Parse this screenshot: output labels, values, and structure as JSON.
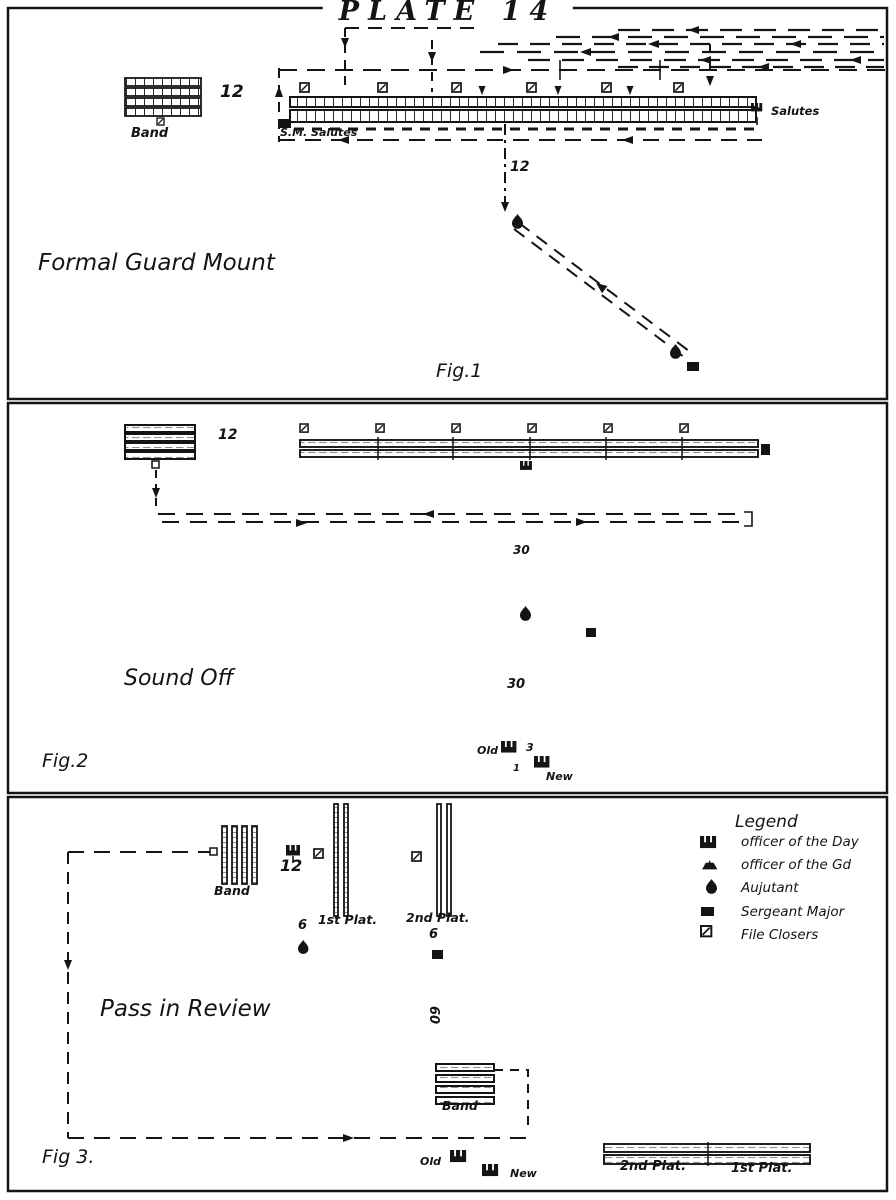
{
  "page": {
    "title": "PLATE 14"
  },
  "fig1": {
    "title": "Formal Guard Mount",
    "fig_label": "Fig.1",
    "band_label": "Band",
    "band_count": "12",
    "sm_salutes": "S.M. Salutes",
    "salutes": "Salutes",
    "distance": "12"
  },
  "fig2": {
    "title": "Sound Off",
    "fig_label": "Fig.2",
    "band_count": "12",
    "distance_upper": "30",
    "distance_lower": "30",
    "old": "Old",
    "gap": "3",
    "step": "1",
    "new": "New"
  },
  "fig3": {
    "title": "Pass in Review",
    "fig_label": "Fig 3.",
    "band_top": "Band",
    "band_bottom": "Band",
    "band_count": "12",
    "plat1": "1st Plat.",
    "plat2": "2nd Plat.",
    "six_a": "6",
    "six_b": "6",
    "sixty": "60",
    "old": "Old",
    "new": "New",
    "bottom_plat2": "2nd Plat.",
    "bottom_plat1": "1st Plat."
  },
  "legend": {
    "title": "Legend",
    "entries": [
      {
        "icon": "officer-of-the-day",
        "label": "officer of the Day"
      },
      {
        "icon": "officer-of-the-guard",
        "label": "officer of the Gd"
      },
      {
        "icon": "adjutant",
        "label": "Aujutant"
      },
      {
        "icon": "sergeant-major",
        "label": "Sergeant Major"
      },
      {
        "icon": "file-closers",
        "label": "File Closers"
      }
    ]
  },
  "colors": {
    "ink": "#141414",
    "paper": "#ffffff"
  }
}
